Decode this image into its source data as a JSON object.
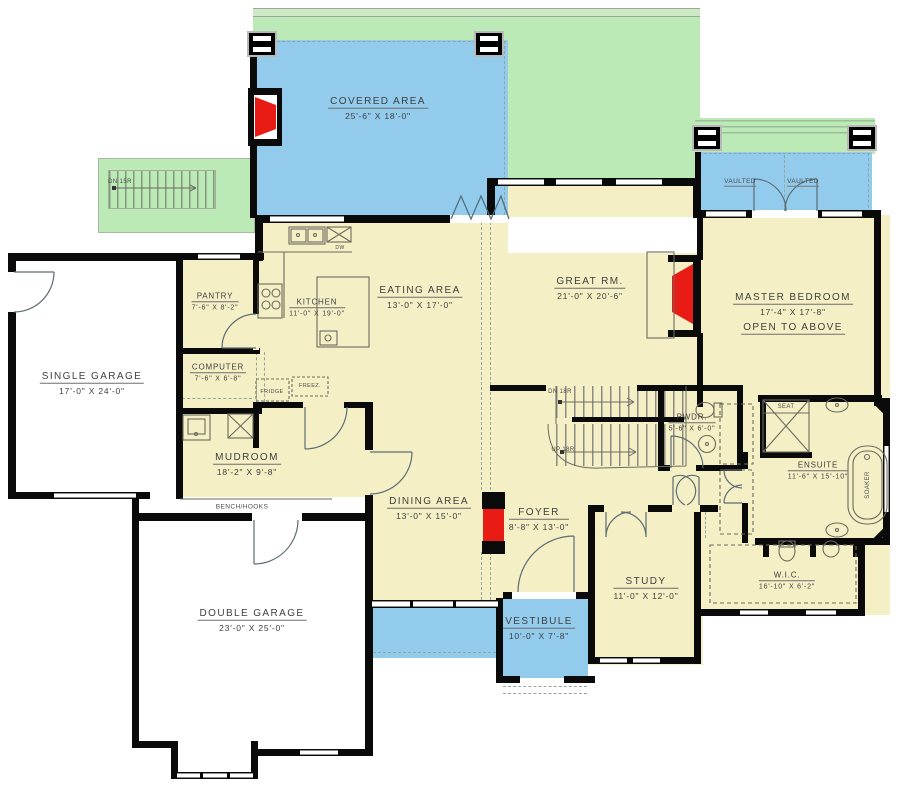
{
  "colors": {
    "lawn": "#bceab6",
    "covered_patio": "#92cbec",
    "interior_floor": "#f5efc6",
    "walls": "#0a0a0a",
    "fireplace_red": "#e81c15"
  },
  "rooms": {
    "covered_area": {
      "name": "COVERED  AREA",
      "dims": "25'-6\" X  18'-0\""
    },
    "single_garage": {
      "name": "SINGLE GARAGE",
      "dims": "17'-0\" X 24'-0\""
    },
    "pantry": {
      "name": "PANTRY",
      "dims": "7'-6\" X 8'-2\""
    },
    "kitchen": {
      "name": "KITCHEN",
      "dims": "11'-0\" X 19'-0\""
    },
    "eating_area": {
      "name": "EATING AREA",
      "dims": "13'-0\" X 17'-0\""
    },
    "great_room": {
      "name": "GREAT RM.",
      "dims": "21'-0\" X 20'-6\""
    },
    "master_bedroom": {
      "name": "MASTER BEDROOM",
      "dims": "17'-4\" X 17'-8\"",
      "note": "OPEN TO ABOVE"
    },
    "computer": {
      "name": "COMPUTER",
      "dims": "7'-6\" X 6'-8\""
    },
    "mudroom": {
      "name": "MUDROOM",
      "dims": "18'-2\" X 9'-8\""
    },
    "powder": {
      "name": "PWDR.",
      "dims": "5'-6\" X 6'-0\""
    },
    "ensuite": {
      "name": "ENSUITE",
      "dims": "11'-6\" X 15'-10\""
    },
    "dining_area": {
      "name": "DINING AREA",
      "dims": "13'-0\" X 15'-0\""
    },
    "foyer": {
      "name": "FOYER",
      "dims": "8'-8\" X 13'-0\""
    },
    "double_garage": {
      "name": "DOUBLE GARAGE",
      "dims": "23'-0\" X 25'-0\""
    },
    "study": {
      "name": "STUDY",
      "dims": "11'-0\" X 12'-0\""
    },
    "vestibule": {
      "name": "VESTIBULE",
      "dims": "10'-0\" X 7'-8\""
    },
    "wic": {
      "name": "W.I.C.",
      "dims": "16'-10\" X 6'-2\""
    }
  },
  "annotations": {
    "vaulted_left": "VAULTED",
    "vaulted_right": "VAULTED",
    "bench_hooks": "BENCH/HOOKS",
    "fridge": "FRIDGE",
    "freezer": "FREEZ.",
    "dw": "DW",
    "seat": "SEAT",
    "soaker": "SOAKER",
    "stairs_down_main": "DN 18R",
    "stairs_up_main": "UP 18R",
    "stairs_down_exterior": "DN 15R"
  }
}
